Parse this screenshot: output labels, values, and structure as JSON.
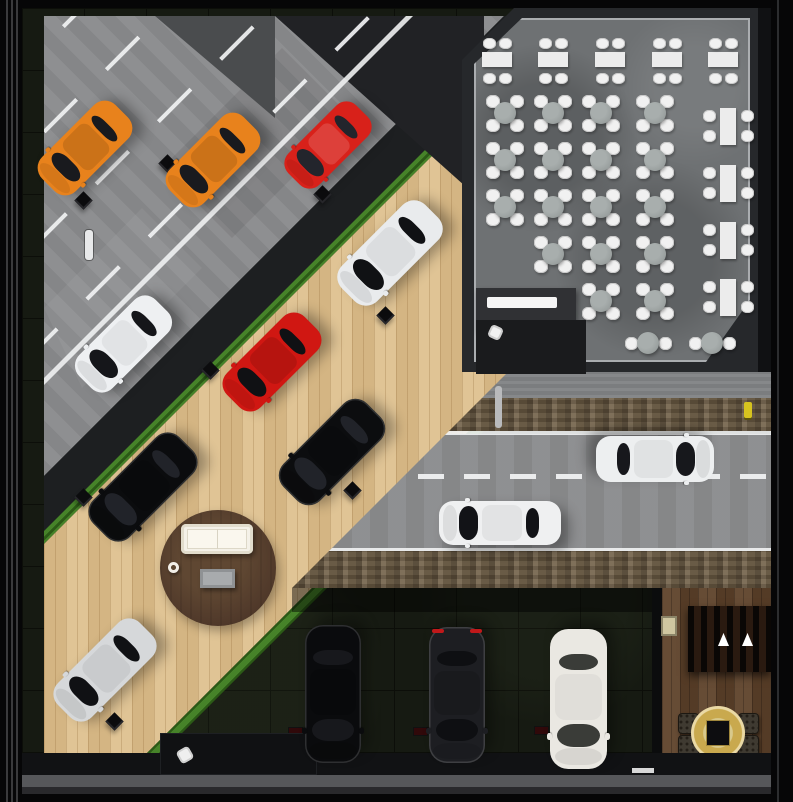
{
  "palette": {
    "frame": "#060607",
    "frame_line": "#3a3a3c",
    "road_concrete": "#8a8b8d",
    "asphalt": "#1d1f21",
    "asphalt_patch": "#212225",
    "gray_patch": "#4a4c4e",
    "grass": "#3c7c1e",
    "wood_floor": "#ddbf8c",
    "garage_floor": "#161a12",
    "garage_grid": "#0c0e09",
    "restaurant_wall": "#26282b",
    "restaurant_floor": "#6e7173",
    "restaurant_outer": "#101113",
    "sidewalk": "#808284",
    "dirt": "#6e5d45",
    "highway_asphalt": "#8b8c8e",
    "marking_white": "#f0f1f2",
    "rug_wood": "#50392a",
    "sofa_white": "#f4f1e8",
    "step_gray": "#56575a",
    "lounge_wood": "#5e422a",
    "gold": "#c9a94e",
    "chair_white": "#f1f1f1",
    "table_white": "#ececec",
    "round_table_gray": "#9aa09f",
    "desk_dark_upper": "#303134",
    "desk_dark_lower": "#1a1b1d",
    "hydrant_yellow": "#d6c31f",
    "taillight_red": "#c0181a"
  },
  "frame": {
    "inner": [
      22,
      8,
      771,
      794
    ],
    "left_lines_x": [
      6,
      11,
      16
    ],
    "right_line_x": 777
  },
  "diagonal": {
    "bands": [
      [
        "diagonal-road-concrete",
        -999,
        490,
        "road"
      ],
      [
        "asphalt-curb-band",
        490,
        545,
        "asphalt"
      ],
      [
        "grass-strip-upper",
        545,
        558,
        "grass"
      ],
      [
        "showroom-wood-floor",
        558,
        870,
        "wood"
      ],
      [
        "grass-strip-lower",
        870,
        885,
        "grass"
      ]
    ],
    "dashed_line_sums": [
      60,
      145,
      250,
      355
    ],
    "solid_line_sums": [
      395
    ],
    "asphalt_patch_top": [
      [
        253,
        8
      ],
      [
        462,
        8
      ],
      [
        462,
        195
      ]
    ],
    "gray_patch_top": [
      [
        133,
        8
      ],
      [
        253,
        8
      ],
      [
        253,
        110
      ]
    ],
    "door_marker": [
      85,
      230,
      8,
      30
    ],
    "wheel_stops": [
      [
        167,
        163
      ],
      [
        83,
        200
      ],
      [
        322,
        194
      ],
      [
        385,
        315
      ],
      [
        210,
        370
      ],
      [
        83,
        497
      ],
      [
        352,
        490
      ],
      [
        114,
        721
      ]
    ]
  },
  "showroom": {
    "rug": {
      "x": 218,
      "y": 568,
      "r": 58
    },
    "sofa": [
      181,
      524,
      72,
      30
    ],
    "coffee_table": [
      200,
      569,
      35,
      19
    ],
    "cup": [
      168,
      562,
      11
    ]
  },
  "restaurant": {
    "block": [
      462,
      8,
      296,
      364
    ],
    "floor": [
      474,
      18,
      276,
      344
    ],
    "top_tables_x": [
      497,
      553,
      610,
      667,
      723
    ],
    "top_table_y": 52,
    "grid_tables": [
      [
        505,
        113
      ],
      [
        553,
        113
      ],
      [
        601,
        113
      ],
      [
        655,
        113
      ],
      [
        505,
        160
      ],
      [
        553,
        160
      ],
      [
        601,
        160
      ],
      [
        655,
        160
      ],
      [
        505,
        207
      ],
      [
        553,
        207
      ],
      [
        601,
        207
      ],
      [
        655,
        207
      ],
      [
        553,
        254
      ],
      [
        601,
        254
      ],
      [
        655,
        254
      ],
      [
        601,
        301
      ],
      [
        655,
        301
      ]
    ],
    "side_tables": {
      "x": 728,
      "ys": [
        126,
        183,
        240,
        297
      ]
    },
    "bottom_tables": [
      [
        648,
        343
      ],
      [
        712,
        343
      ]
    ],
    "desk": {
      "upper": [
        476,
        288,
        100,
        42
      ],
      "lower": [
        476,
        320,
        110,
        54
      ],
      "counter": [
        487,
        297,
        70,
        11
      ],
      "chair": [
        489,
        326
      ]
    }
  },
  "highway": {
    "clip": [
      [
        508,
        372
      ],
      [
        771,
        372
      ],
      [
        771,
        588
      ],
      [
        292,
        588
      ]
    ],
    "sidewalk": [
      372,
      398
    ],
    "dirt_top": [
      398,
      431
    ],
    "line_top_y": 431,
    "road": [
      434,
      551
    ],
    "dash_y": 474,
    "line_bottom_y": 548,
    "dirt_bottom": [
      551,
      588
    ],
    "pole": [
      495,
      386,
      7,
      42
    ],
    "hydrant": [
      744,
      402,
      8,
      16
    ]
  },
  "garage": {
    "entrance_shadow": [
      292,
      588,
      370,
      24
    ],
    "stops": [
      [
        420,
        732
      ],
      [
        541,
        731
      ],
      [
        295,
        732
      ]
    ],
    "white_strip": [
      632,
      768,
      22,
      5
    ],
    "workstation": {
      "desk": [
        160,
        733,
        157,
        42
      ],
      "chair": [
        178,
        748
      ]
    }
  },
  "lounge": {
    "wall": [
      652,
      588,
      10,
      187
    ],
    "room": [
      662,
      588,
      109,
      187
    ],
    "slats": [
      688,
      606,
      83,
      66
    ],
    "lights": [
      [
        723,
        644
      ],
      [
        747,
        644
      ]
    ],
    "panel": [
      661,
      616,
      16,
      20
    ],
    "chairs": [
      [
        678,
        713
      ],
      [
        678,
        735
      ],
      [
        738,
        713
      ],
      [
        738,
        735
      ]
    ],
    "chair_size": 21,
    "rug": {
      "x": 718,
      "y": 733,
      "r": 27
    },
    "table": [
      706,
      720,
      24,
      26
    ]
  },
  "bottom_bands": [
    [
      753,
      22,
      "#111214"
    ],
    [
      775,
      12,
      "#56575a"
    ],
    [
      787,
      7,
      "#29292c"
    ]
  ],
  "cars": [
    {
      "name": "orange-coupe-street-1",
      "x": 85,
      "y": 148,
      "rot": -135,
      "len": 104,
      "wid": 48,
      "color": "#e8821c",
      "glass": "#191a1e"
    },
    {
      "name": "orange-coupe-street-2",
      "x": 213,
      "y": 160,
      "rot": -135,
      "len": 104,
      "wid": 48,
      "color": "#e8821c",
      "glass": "#191a1e"
    },
    {
      "name": "red-hatch-street",
      "x": 328,
      "y": 145,
      "rot": -135,
      "len": 96,
      "wid": 44,
      "color": "#d8211a",
      "glass": "#23252c",
      "roof": "rgba(255,255,255,0.14)"
    },
    {
      "name": "white-wagon-street",
      "x": 123,
      "y": 344,
      "rot": -135,
      "len": 108,
      "wid": 47,
      "color": "#eef0f2",
      "glass": "#15161a",
      "roof": "rgba(0,0,0,0.05)"
    },
    {
      "name": "white-suv-showroom",
      "x": 390,
      "y": 253,
      "rot": -135,
      "len": 118,
      "wid": 50,
      "color": "#e9ebed",
      "glass": "#101114",
      "roof": "rgba(0,0,0,0.06)"
    },
    {
      "name": "red-sedan-showroom",
      "x": 272,
      "y": 362,
      "rot": -135,
      "len": 110,
      "wid": 48,
      "color": "#d01712",
      "glass": "#101114"
    },
    {
      "name": "black-suv-showroom-right",
      "x": 332,
      "y": 452,
      "rot": -135,
      "len": 118,
      "wid": 52,
      "color": "#0c0d0f",
      "glass": "#212329",
      "dark": true
    },
    {
      "name": "black-suv-showroom-left",
      "x": 143,
      "y": 487,
      "rot": -135,
      "len": 122,
      "wid": 52,
      "color": "#0b0c0e",
      "glass": "#212329",
      "dark": true
    },
    {
      "name": "silver-hatch-showroom",
      "x": 105,
      "y": 670,
      "rot": -135,
      "len": 116,
      "wid": 48,
      "color": "#d6d8da",
      "glass": "#101114",
      "roof": "rgba(0,0,0,0.06)"
    },
    {
      "name": "white-suv-highway",
      "x": 655,
      "y": 459,
      "rot": 90,
      "len": 118,
      "wid": 46,
      "color": "#edeff0",
      "glass": "#17181c",
      "roof": "rgba(0,0,0,0.05)"
    },
    {
      "name": "white-sedan-highway",
      "x": 500,
      "y": 523,
      "rot": -90,
      "len": 122,
      "wid": 44,
      "color": "#eff0f1",
      "glass": "#121317",
      "roof": "rgba(0,0,0,0.05)"
    },
    {
      "name": "black-sedan-garage",
      "x": 333,
      "y": 694,
      "rot": 180,
      "len": 138,
      "wid": 56,
      "color": "#0a0b0d",
      "glass": "#17181c",
      "dark": true
    },
    {
      "name": "gray-sedan-garage",
      "x": 457,
      "y": 695,
      "rot": 180,
      "len": 136,
      "wid": 56,
      "color": "#1d1e22",
      "glass": "#0e0f12",
      "dark": true,
      "tail": true
    },
    {
      "name": "white-van-garage",
      "x": 578,
      "y": 699,
      "rot": 180,
      "len": 140,
      "wid": 57,
      "color": "#eae8e2",
      "glass": "#3a3c38",
      "roof": "rgba(0,0,0,0.04)"
    }
  ]
}
